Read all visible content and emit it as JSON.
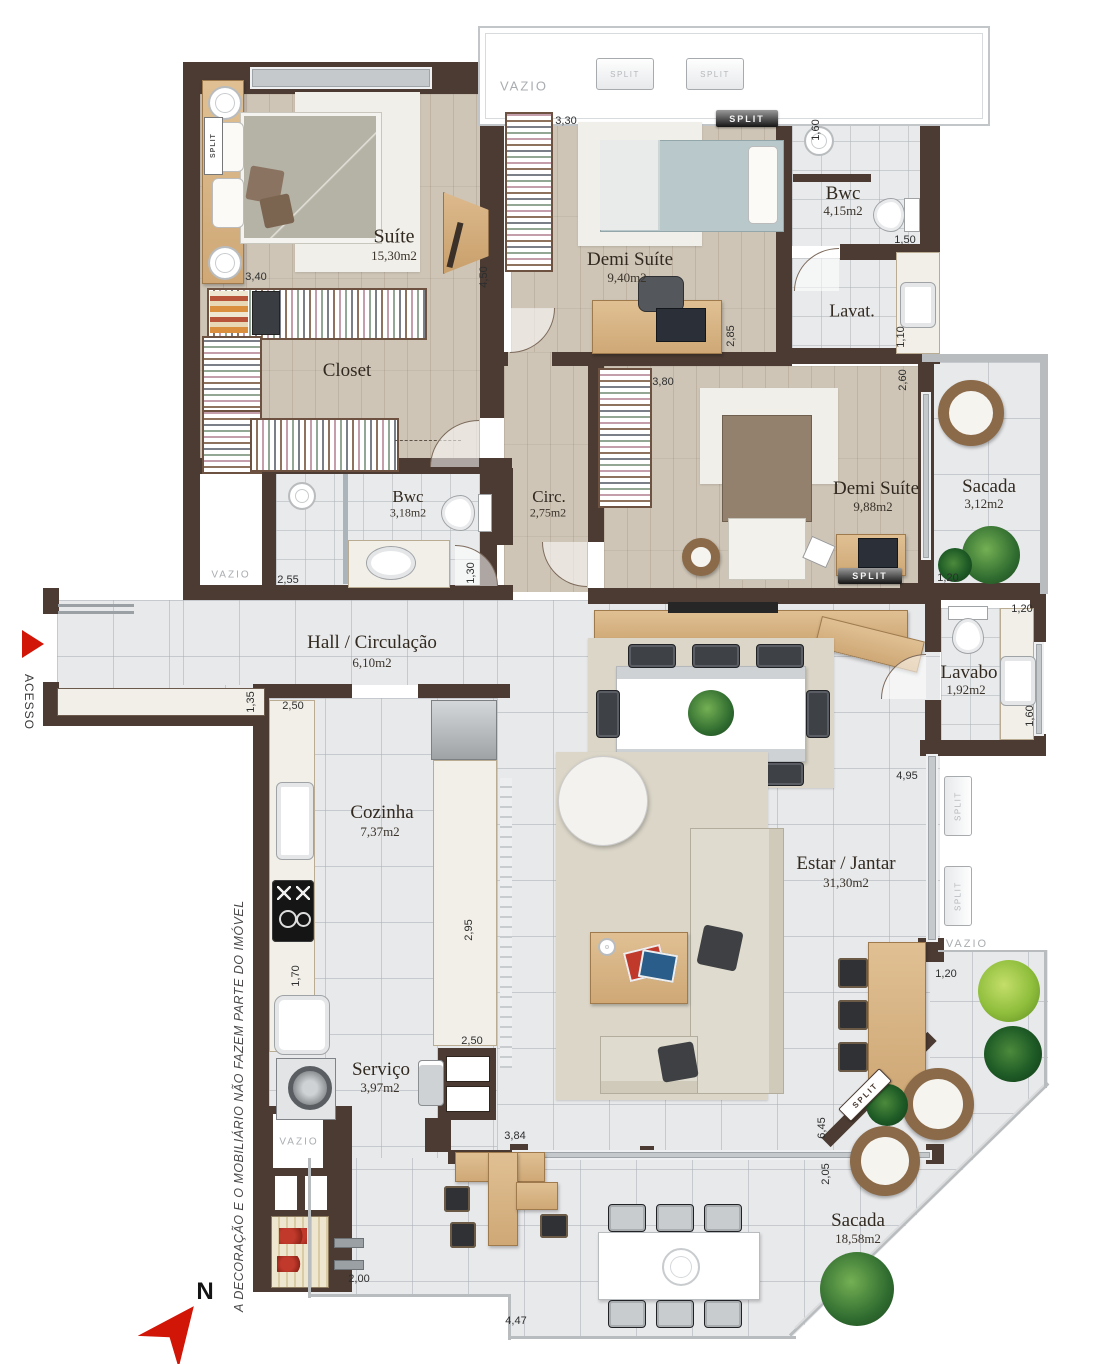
{
  "plan": {
    "rooms": [
      {
        "name": "Suíte",
        "area": "15,30m2"
      },
      {
        "name": "Demi Suíte",
        "area": "9,40m2"
      },
      {
        "name": "Bwc",
        "area": "4,15m2"
      },
      {
        "name": "Lavat.",
        "area": ""
      },
      {
        "name": "Closet",
        "area": ""
      },
      {
        "name": "Bwc",
        "area": "3,18m2"
      },
      {
        "name": "Circ.",
        "area": "2,75m2"
      },
      {
        "name": "Demi Suíte",
        "area": "9,88m2"
      },
      {
        "name": "Sacada",
        "area": "3,12m2"
      },
      {
        "name": "Hall / Circulação",
        "area": "6,10m2"
      },
      {
        "name": "Lavabo",
        "area": "1,92m2"
      },
      {
        "name": "Cozinha",
        "area": "7,37m2"
      },
      {
        "name": "Estar / Jantar",
        "area": "31,30m2"
      },
      {
        "name": "Serviço",
        "area": "3,97m2"
      },
      {
        "name": "Sacada",
        "area": "18,58m2"
      }
    ],
    "dimensions": [
      "3,40",
      "4,50",
      "3,30",
      "1,60",
      "1,50",
      "1,10",
      "2,85",
      "2,60",
      "3,80",
      "2,55",
      "1,30",
      "1,20",
      "1,20",
      "1,35",
      "2,50",
      "1,70",
      "2,95",
      "2,50",
      "3,84",
      "2,00",
      "4,47",
      "6,45",
      "2,05",
      "4,95",
      "1,60",
      "1,20"
    ],
    "labels": {
      "split": "SPLIT",
      "vazio": "VAZIO"
    },
    "notes": {
      "disclaimer": "A  DECORAÇÃO E O MOBILIÁRIO NÃO FAZEM PARTE DO IMÓVEL",
      "access": "ACESSO",
      "north": "N"
    },
    "colors": {
      "wall": "#4b3b32",
      "wood_floor": "#cec5b6",
      "tile_floor": "#e8e9eb",
      "furniture_wood": "#d7b584",
      "accent_red": "#d11507"
    }
  }
}
